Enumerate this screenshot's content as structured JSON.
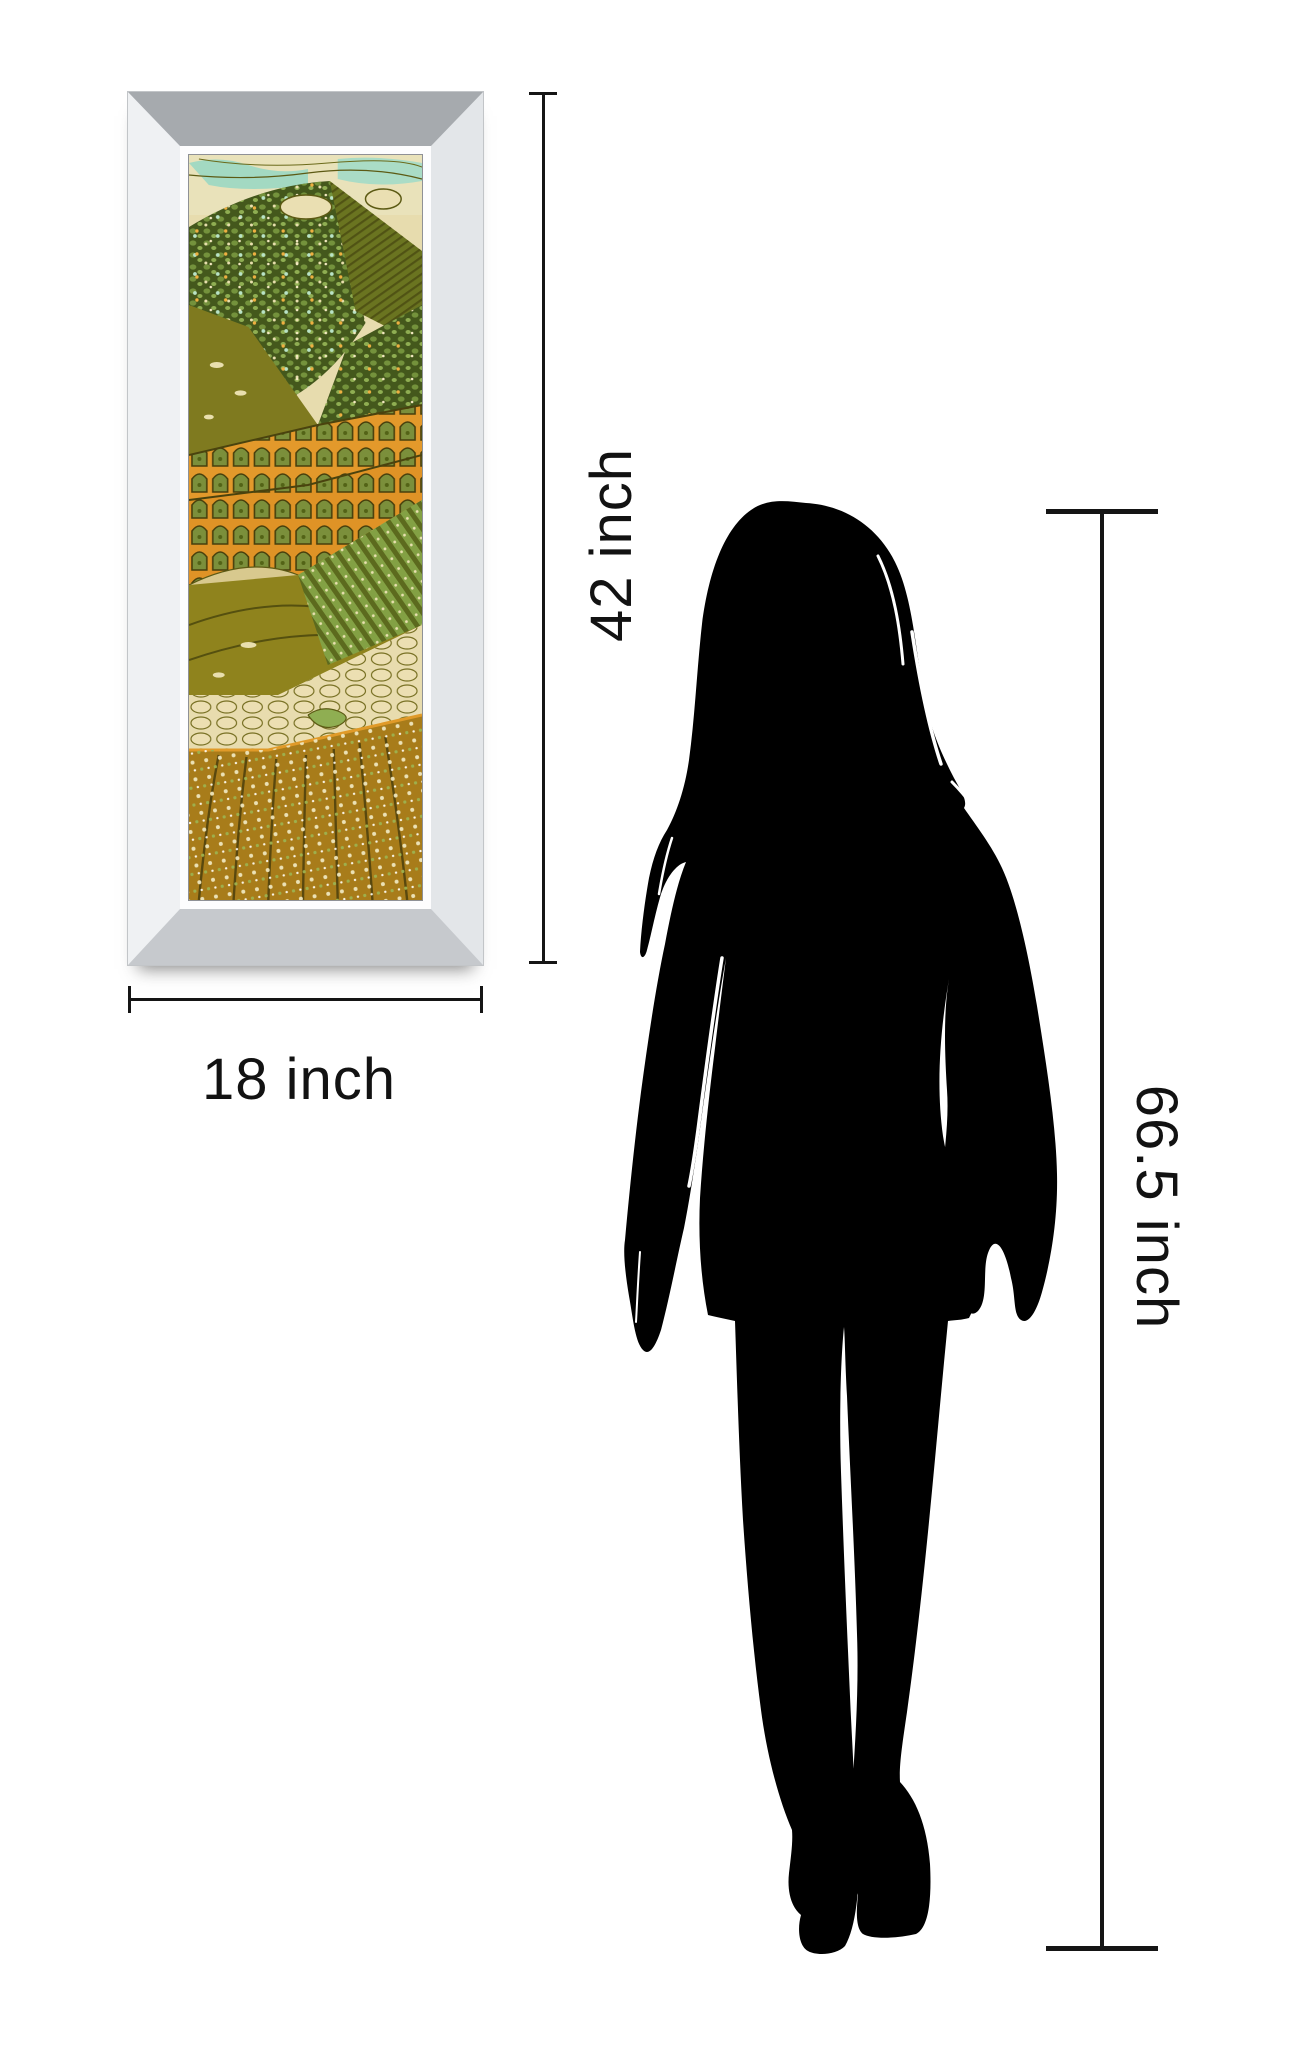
{
  "image": {
    "type": "product size comparison",
    "background_color": "#ffffff"
  },
  "framed_art": {
    "description": "mirrored bevel framed abstract batik landscape print, green olive orange terraced fields",
    "frame_bevel_colors": {
      "top": "#a6aaae",
      "left": "#eff1f3",
      "right": "#e3e6e9",
      "bottom": "#c6c9cd",
      "lip": "#fdfdfe"
    },
    "art_palette": {
      "sky_cream": "#e9e2ba",
      "sky_teal": "#a3d9c2",
      "hill_dark_green": "#44581c",
      "pebble_green": "#74923c",
      "olive_field": "#7f7a1f",
      "orange_terrace": "#e3992b",
      "gold_field": "#8f831d",
      "stone_cream": "#e8dcae",
      "furrow_brown": "#a87c1a",
      "outline_dark": "#4a430e"
    }
  },
  "annotations": {
    "art_height_label": "42 inch",
    "art_width_label": "18 inch",
    "person_height_label": "66.5 inch",
    "line_color": "#151515",
    "text_color": "#121212"
  },
  "person": {
    "description": "standing woman silhouette, shoulder-length hair, short dress, platform heels",
    "color": "#000000"
  }
}
